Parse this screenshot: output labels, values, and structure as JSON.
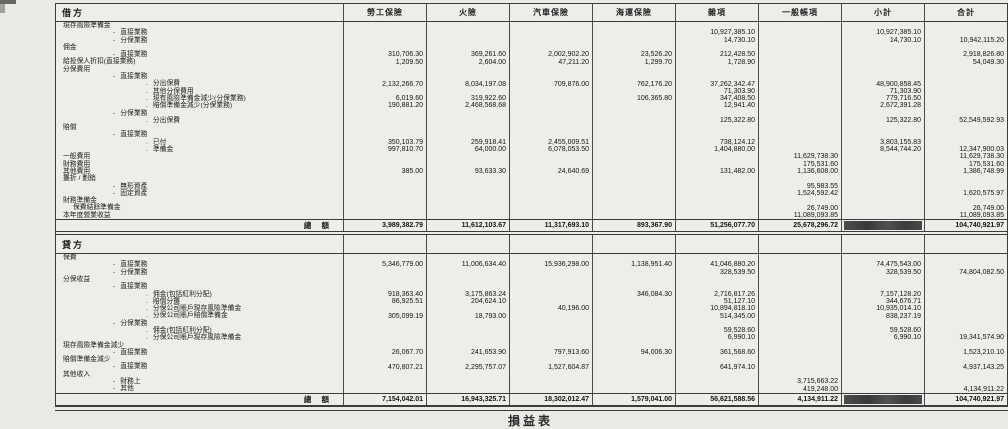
{
  "page": {
    "caption": "損益表"
  },
  "colors": {
    "paper": "#e9e9e5",
    "ink": "#1d1d1d",
    "rule": "#3c3c3c",
    "redaction": "#474747"
  },
  "table": {
    "debit_header": "借方",
    "credit_header": "貸方",
    "total_label": "總 額",
    "columns": [
      "勞工保險",
      "火險",
      "汽車保險",
      "海運保險",
      "雜項",
      "一般帳項",
      "小計",
      "合計"
    ],
    "debit_rows": [
      {
        "label": "現存風險準備金",
        "indent": 0,
        "bullet": "",
        "values": [
          "",
          "",
          "",
          "",
          "",
          "",
          "",
          ""
        ]
      },
      {
        "label": "直接業務",
        "indent": 1,
        "bullet": "-",
        "values": [
          "",
          "",
          "",
          "",
          "10,927,385.10",
          "",
          "10,927,385.10",
          ""
        ]
      },
      {
        "label": "分保業務",
        "indent": 1,
        "bullet": "-",
        "values": [
          "",
          "",
          "",
          "",
          "14,730.10",
          "",
          "14,730.10",
          "10,942,115.20"
        ]
      },
      {
        "label": "佣金",
        "indent": 0,
        "bullet": "",
        "values": [
          "",
          "",
          "",
          "",
          "",
          "",
          "",
          ""
        ]
      },
      {
        "label": "直接業務",
        "indent": 1,
        "bullet": "-",
        "values": [
          "310,706.30",
          "369,261.60",
          "2,002,902.20",
          "23,526.20",
          "212,428.50",
          "",
          "",
          "2,918,826.80"
        ]
      },
      {
        "label": "給投保人折扣(直接業務)",
        "indent": 0,
        "bullet": "",
        "values": [
          "1,209.50",
          "2,604.00",
          "47,211.20",
          "1,299.70",
          "1,728.90",
          "",
          "",
          "54,049.30"
        ]
      },
      {
        "label": "分保費用",
        "indent": 0,
        "bullet": "",
        "values": [
          "",
          "",
          "",
          "",
          "",
          "",
          "",
          ""
        ]
      },
      {
        "label": "直接業務",
        "indent": 1,
        "bullet": "-",
        "values": [
          "",
          "",
          "",
          "",
          "",
          "",
          "",
          ""
        ]
      },
      {
        "label": "分出保費",
        "indent": 2,
        "bullet": ".",
        "values": [
          "2,132,266.70",
          "8,034,197.08",
          "709,876.00",
          "762,176.20",
          "37,262,342.47",
          "",
          "48,900,858.45",
          ""
        ]
      },
      {
        "label": "其他分保費用",
        "indent": 2,
        "bullet": ".",
        "values": [
          "",
          "",
          "",
          "",
          "71,303.90",
          "",
          "71,303.90",
          ""
        ]
      },
      {
        "label": "現有風險準備金減少(分保業務)",
        "indent": 2,
        "bullet": ".",
        "values": [
          "6,019.60",
          "319,922.60",
          "",
          "106,365.80",
          "347,408.50",
          "",
          "779,716.50",
          ""
        ]
      },
      {
        "label": "賠償準備金減少(分保業務)",
        "indent": 2,
        "bullet": ".",
        "values": [
          "190,881.20",
          "2,468,568.68",
          "",
          "",
          "12,941.40",
          "",
          "2,672,391.28",
          ""
        ]
      },
      {
        "label": "分保業務",
        "indent": 1,
        "bullet": "-",
        "values": [
          "",
          "",
          "",
          "",
          "",
          "",
          "",
          ""
        ]
      },
      {
        "label": "分出保費",
        "indent": 2,
        "bullet": ".",
        "values": [
          "",
          "",
          "",
          "",
          "125,322.80",
          "",
          "125,322.80",
          "52,549,592.93"
        ]
      },
      {
        "label": "賠償",
        "indent": 0,
        "bullet": "",
        "values": [
          "",
          "",
          "",
          "",
          "",
          "",
          "",
          ""
        ]
      },
      {
        "label": "直接業務",
        "indent": 1,
        "bullet": "-",
        "values": [
          "",
          "",
          "",
          "",
          "",
          "",
          "",
          ""
        ]
      },
      {
        "label": "已付",
        "indent": 2,
        "bullet": ".",
        "values": [
          "350,103.79",
          "259,918.41",
          "2,455,009.51",
          "",
          "738,124.12",
          "",
          "3,803,155.83",
          ""
        ]
      },
      {
        "label": "準備金",
        "indent": 2,
        "bullet": ".",
        "values": [
          "997,810.70",
          "64,000.00",
          "6,078,053.50",
          "",
          "1,404,880.00",
          "",
          "8,544,744.20",
          "12,347,900.03"
        ]
      },
      {
        "label": "一般費用",
        "indent": 0,
        "bullet": "",
        "values": [
          "",
          "",
          "",
          "",
          "",
          "11,629,738.30",
          "",
          "11,629,738.30"
        ]
      },
      {
        "label": "財務費用",
        "indent": 0,
        "bullet": "",
        "values": [
          "",
          "",
          "",
          "",
          "",
          "175,531.60",
          "",
          "175,531.60"
        ]
      },
      {
        "label": "其他費用",
        "indent": 0,
        "bullet": "",
        "values": [
          "385.00",
          "93,633.30",
          "24,640.69",
          "",
          "131,482.00",
          "1,136,608.00",
          "",
          "1,386,748.99"
        ]
      },
      {
        "label": "攤折 / 劃銷",
        "indent": 0,
        "bullet": "",
        "values": [
          "",
          "",
          "",
          "",
          "",
          "",
          "",
          ""
        ]
      },
      {
        "label": "無形資產",
        "indent": 1,
        "bullet": "-",
        "values": [
          "",
          "",
          "",
          "",
          "",
          "95,983.55",
          "",
          ""
        ]
      },
      {
        "label": "固定資產",
        "indent": 1,
        "bullet": "-",
        "values": [
          "",
          "",
          "",
          "",
          "",
          "1,524,592.42",
          "",
          "1,620,575.97"
        ]
      },
      {
        "label": "財務準備金",
        "indent": 0,
        "bullet": "",
        "values": [
          "",
          "",
          "",
          "",
          "",
          "",
          "",
          ""
        ]
      },
      {
        "label": "保費結餘準備金",
        "indent": 3,
        "bullet": "",
        "values": [
          "",
          "",
          "",
          "",
          "",
          "26,749.00",
          "",
          "26,749.00"
        ]
      },
      {
        "label": "本年度營業收益",
        "indent": 0,
        "bullet": "",
        "values": [
          "",
          "",
          "",
          "",
          "",
          "11,089,093.85",
          "",
          "11,089,093.85"
        ]
      }
    ],
    "debit_total": {
      "values": [
        "3,989,382.79",
        "11,612,103.67",
        "11,317,693.10",
        "893,367.90",
        "51,256,077.70",
        "25,678,296.72",
        "",
        "104,740,921.97"
      ],
      "redacted_column": 6
    },
    "credit_rows": [
      {
        "label": "保費",
        "indent": 0,
        "bullet": "",
        "values": [
          "",
          "",
          "",
          "",
          "",
          "",
          "",
          ""
        ]
      },
      {
        "label": "直接業務",
        "indent": 1,
        "bullet": "-",
        "values": [
          "5,346,779.00",
          "11,006,634.40",
          "15,936,298.00",
          "1,138,951.40",
          "41,046,880.20",
          "",
          "74,475,543.00",
          ""
        ]
      },
      {
        "label": "分保業務",
        "indent": 1,
        "bullet": "-",
        "values": [
          "",
          "",
          "",
          "",
          "328,539.50",
          "",
          "328,539.50",
          "74,804,082.50"
        ]
      },
      {
        "label": "分保收益",
        "indent": 0,
        "bullet": "",
        "values": [
          "",
          "",
          "",
          "",
          "",
          "",
          "",
          ""
        ]
      },
      {
        "label": "直接業務",
        "indent": 1,
        "bullet": "-",
        "values": [
          "",
          "",
          "",
          "",
          "",
          "",
          "",
          ""
        ]
      },
      {
        "label": "佣金(包括紅利分配)",
        "indent": 2,
        "bullet": ".",
        "values": [
          "918,363.40",
          "3,175,863.24",
          "",
          "346,084.30",
          "2,716,817.26",
          "",
          "7,157,128.20",
          ""
        ]
      },
      {
        "label": "賠償分攤",
        "indent": 2,
        "bullet": ".",
        "values": [
          "86,925.51",
          "204,624.10",
          "",
          "",
          "51,127.10",
          "",
          "344,676.71",
          ""
        ]
      },
      {
        "label": "分保公司賬戶現存風險準備金",
        "indent": 2,
        "bullet": ".",
        "values": [
          "",
          "",
          "40,196.00",
          "",
          "10,894,818.10",
          "",
          "10,935,014.10",
          ""
        ]
      },
      {
        "label": "分保公司賬戶賠償準備金",
        "indent": 2,
        "bullet": ".",
        "values": [
          "305,099.19",
          "18,793.00",
          "",
          "",
          "514,345.00",
          "",
          "838,237.19",
          ""
        ]
      },
      {
        "label": "分保業務",
        "indent": 1,
        "bullet": "-",
        "values": [
          "",
          "",
          "",
          "",
          "",
          "",
          "",
          ""
        ]
      },
      {
        "label": "佣金(包括紅利分配)",
        "indent": 2,
        "bullet": ".",
        "values": [
          "",
          "",
          "",
          "",
          "59,528.60",
          "",
          "59,528.60",
          ""
        ]
      },
      {
        "label": "分保公司賬戶現存風險準備金",
        "indent": 2,
        "bullet": ".",
        "values": [
          "",
          "",
          "",
          "",
          "6,990.10",
          "",
          "6,990.10",
          "19,341,574.90"
        ]
      },
      {
        "label": "現存風險準備金減少",
        "indent": 0,
        "bullet": "",
        "values": [
          "",
          "",
          "",
          "",
          "",
          "",
          "",
          ""
        ]
      },
      {
        "label": "直接業務",
        "indent": 1,
        "bullet": "-",
        "values": [
          "26,067.70",
          "241,653.90",
          "797,913.60",
          "94,006.30",
          "361,568.60",
          "",
          "",
          "1,523,210.10"
        ]
      },
      {
        "label": "賠償準備金減少",
        "indent": 0,
        "bullet": "",
        "values": [
          "",
          "",
          "",
          "",
          "",
          "",
          "",
          ""
        ]
      },
      {
        "label": "直接業務",
        "indent": 1,
        "bullet": "-",
        "values": [
          "470,807.21",
          "2,295,757.07",
          "1,527,604.87",
          "",
          "641,974.10",
          "",
          "",
          "4,937,143.25"
        ]
      },
      {
        "label": "其他收入",
        "indent": 0,
        "bullet": "",
        "values": [
          "",
          "",
          "",
          "",
          "",
          "",
          "",
          ""
        ]
      },
      {
        "label": "財務上",
        "indent": 1,
        "bullet": "-",
        "values": [
          "",
          "",
          "",
          "",
          "",
          "3,715,663.22",
          "",
          ""
        ]
      },
      {
        "label": "其他",
        "indent": 1,
        "bullet": "-",
        "values": [
          "",
          "",
          "",
          "",
          "",
          "419,248.00",
          "",
          "4,134,911.22"
        ]
      }
    ],
    "credit_total": {
      "values": [
        "7,154,042.01",
        "16,943,325.71",
        "18,302,012.47",
        "1,579,041.00",
        "56,621,588.56",
        "4,134,911.22",
        "",
        "104,740,921.97"
      ],
      "redacted_column": 6
    }
  }
}
